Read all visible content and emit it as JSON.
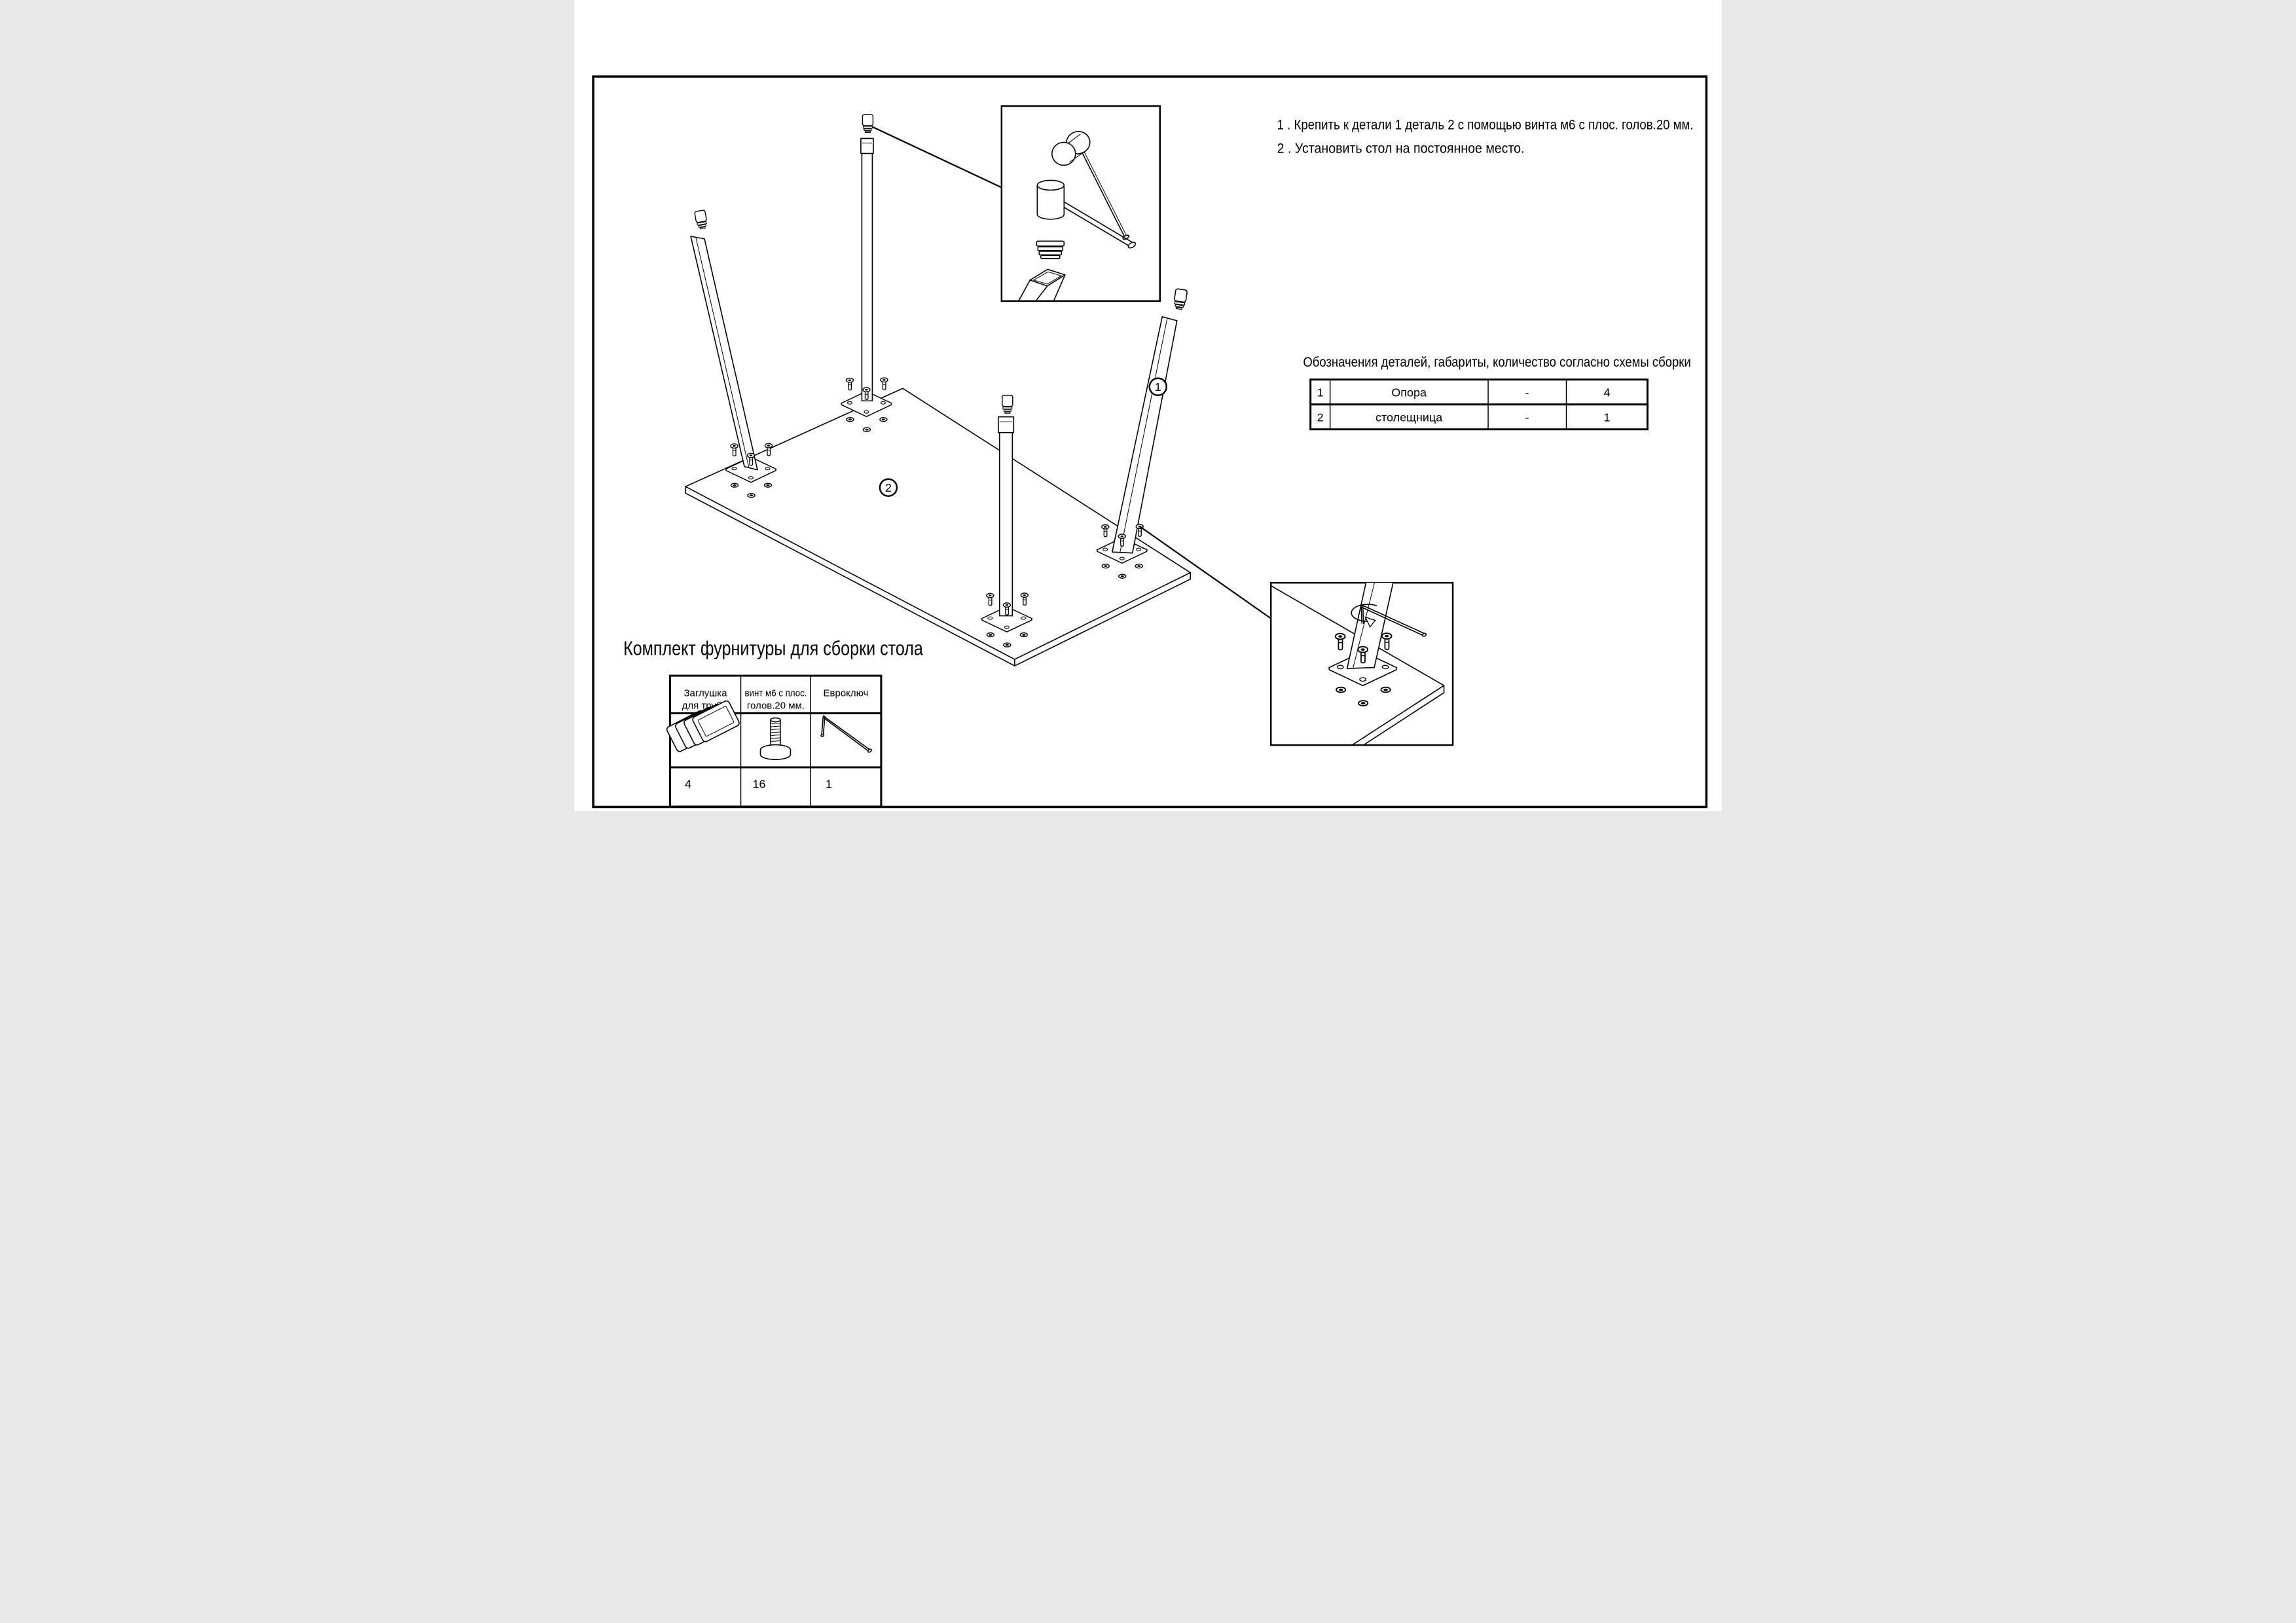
{
  "document": {
    "type": "assembly-drawing",
    "language": "ru",
    "paper_color": "#ffffff",
    "ink_color": "#000000"
  },
  "instructions": {
    "line1": "1 . Крепить к детали 1 деталь 2 с помощью винта м6 с плос. голов.20 мм.",
    "line2": "2 . Установить стол на постоянное место."
  },
  "parts_table": {
    "title": "Обозначения деталей, габариты, количество согласно схемы сборки",
    "rows": [
      {
        "num": "1",
        "name": "Опора",
        "dim": "-",
        "qty": "4"
      },
      {
        "num": "2",
        "name": "столещница",
        "dim": "-",
        "qty": "1"
      }
    ]
  },
  "hardware": {
    "title": "Комплект фурнитуры для сборки стола",
    "columns": [
      {
        "label1": "Заглушка",
        "label2": "для трубы",
        "qty": "4",
        "icon": "tube-cap-stack-icon"
      },
      {
        "label1": "винт м6 с плос.",
        "label2": "голов.20 мм.",
        "qty": "16",
        "icon": "flat-head-screw-icon"
      },
      {
        "label1": "Евроключ",
        "label2": "",
        "qty": "1",
        "icon": "hex-key-icon"
      }
    ]
  },
  "balloons": {
    "b1": "1",
    "b2": "2"
  },
  "legend": {
    "part1": "Опора (leg support), 4 pcs",
    "part2": "столещница (table top), 1 pc"
  }
}
